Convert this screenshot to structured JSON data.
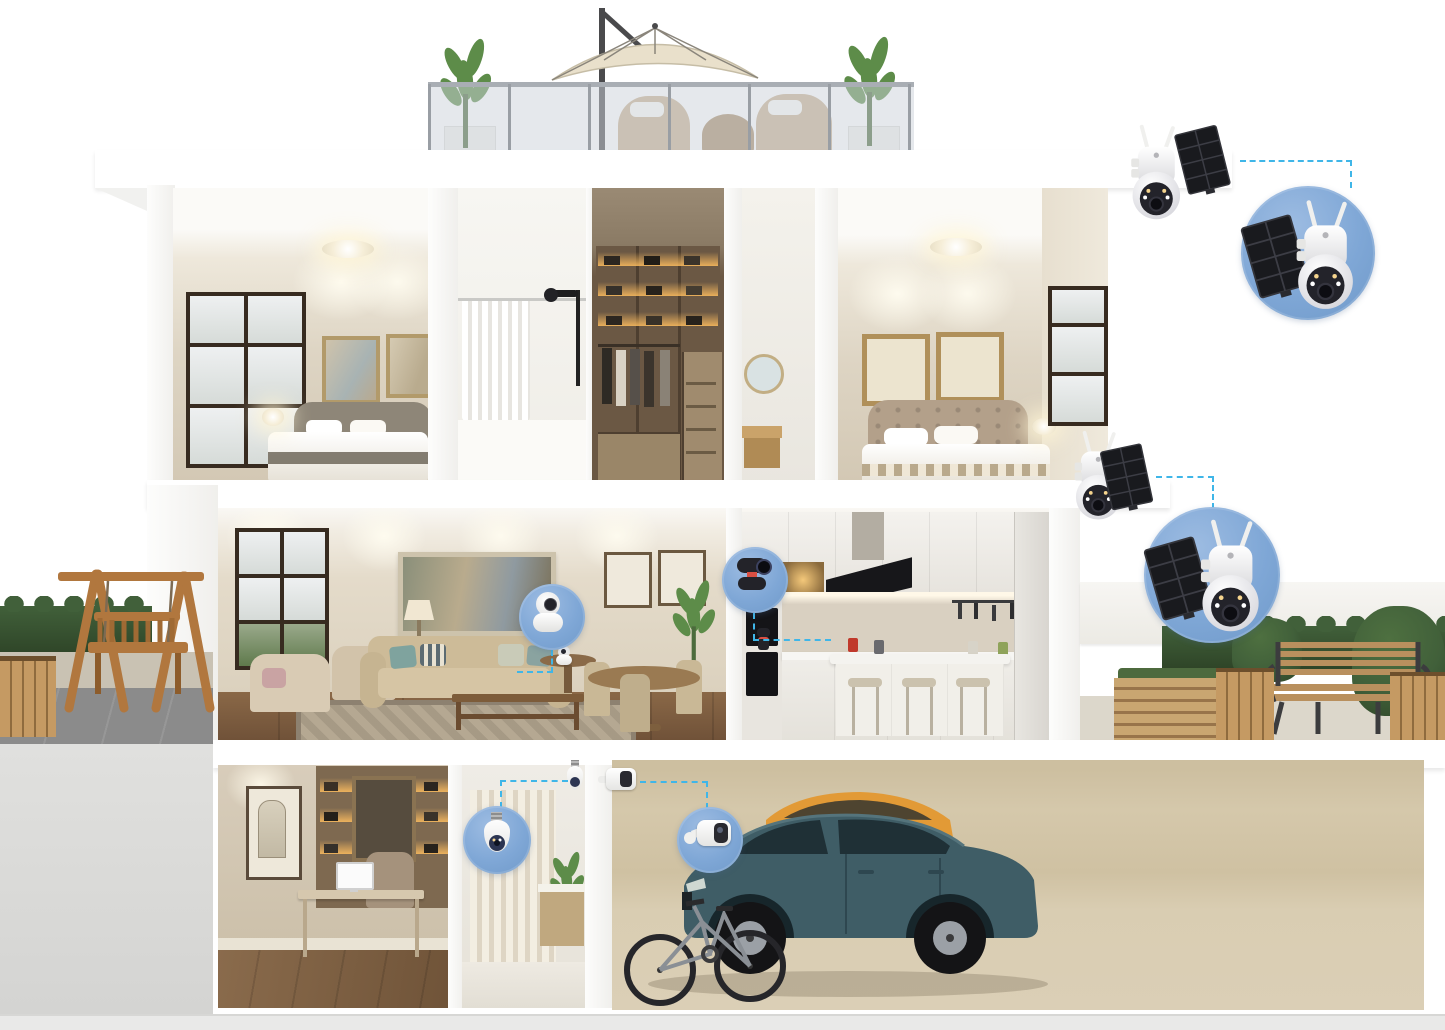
{
  "scene": {
    "name": "smart-home-security-camera-cutaway",
    "description": "Three-level cutaway home illustration showing wireless security camera placements with zoom callouts",
    "levels": [
      {
        "name": "rooftop-terrace",
        "items": [
          "patio-umbrella",
          "glass-railing",
          "potted-plants",
          "wicker-seating"
        ]
      },
      {
        "name": "upper-floor",
        "rooms": [
          "bedroom-left",
          "shower-room",
          "walk-in-closet",
          "hallway-bath",
          "bedroom-right"
        ]
      },
      {
        "name": "main-floor",
        "rooms": [
          "living-room",
          "dining-area",
          "kitchen"
        ]
      },
      {
        "name": "lower-level",
        "rooms": [
          "study",
          "bathroom",
          "garage"
        ]
      },
      {
        "name": "yards",
        "items": [
          "wooden-swing",
          "hedges",
          "garden-bench",
          "planter-boxes",
          "raised-garden-bed",
          "stone-paving"
        ]
      }
    ],
    "vehicles": [
      "teal-suv",
      "orange-car",
      "bicycle"
    ]
  },
  "cameras": [
    {
      "id": "roof-eave-cam",
      "type": "outdoor PTZ security camera with solar panel",
      "location": "roof-right-corner",
      "antennas": 2,
      "callout": "roof-callout"
    },
    {
      "id": "second-floor-corner-cam",
      "type": "outdoor PTZ security camera with solar panel",
      "location": "second-floor-right-corner",
      "antennas": 2,
      "callout": "floor2-callout"
    },
    {
      "id": "living-room-cam",
      "type": "white indoor pan-tilt camera",
      "location": "living-room side table",
      "callout": "living-room-callout"
    },
    {
      "id": "kitchen-cam",
      "type": "black indoor pan-tilt camera",
      "location": "kitchen counter",
      "callout": "kitchen-callout"
    },
    {
      "id": "bulb-cam",
      "type": "light-bulb socket security camera",
      "location": "lower-bathroom doorway",
      "callout": "bulb-callout"
    },
    {
      "id": "garage-cam",
      "type": "white battery cube camera",
      "location": "garage wall",
      "callout": "garage-callout"
    }
  ],
  "callouts": [
    {
      "id": "roof-callout",
      "shape": "circle",
      "size": "large",
      "contains": "PTZ camera with solar panel"
    },
    {
      "id": "floor2-callout",
      "shape": "circle",
      "size": "large",
      "contains": "PTZ camera with solar panel"
    },
    {
      "id": "living-room-callout",
      "shape": "circle",
      "size": "small",
      "contains": "white indoor pan-tilt camera"
    },
    {
      "id": "kitchen-callout",
      "shape": "circle",
      "size": "small",
      "contains": "black indoor pan-tilt camera"
    },
    {
      "id": "bulb-callout",
      "shape": "circle",
      "size": "small",
      "contains": "light-bulb camera"
    },
    {
      "id": "garage-callout",
      "shape": "circle",
      "size": "small",
      "contains": "battery cube camera"
    }
  ],
  "colors": {
    "background": "#ffffff",
    "callout_fill": "#7fa7d6",
    "callout_deep": "#6f99c9",
    "callout_light": "#9dbce2",
    "connector": "#3fb6e8",
    "wall_beige": "#ddd4c4",
    "wall_beige_dark": "#cfc5b2",
    "wood_floor": "#7d5e41",
    "hedge": "#41603a",
    "hedge_dark": "#2e4427",
    "wood_furniture": "#b1773e",
    "solar_panel": "#191a1e",
    "camera_white": "#f4f4f2",
    "camera_dark": "#26262c",
    "accent_red": "#d94f43",
    "suv_teal": "#3f5d66",
    "car_orange": "#e29a36",
    "paving": "#8b8b8b",
    "paving_light": "#c9c2b3",
    "sand_wall": "#d2c5a8",
    "sand_floor": "#dbcfb6",
    "gray_wall": "#dcdcda",
    "ground_strip": "#e9e9e8",
    "glow_amber": "#ffbe5f"
  }
}
